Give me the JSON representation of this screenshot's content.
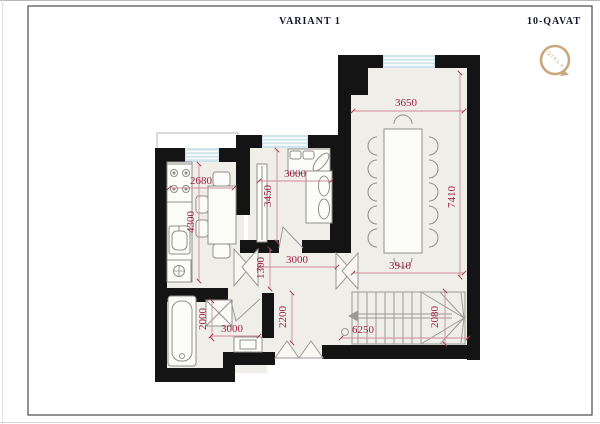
{
  "header": {
    "variant_label": "VARIANT 1",
    "floor_label": "10-QAVAT"
  },
  "logo": {
    "label": "QIBLA"
  },
  "plan": {
    "dimensions": {
      "kitchen_width": "2680",
      "kitchen_depth": "4300",
      "bedroom_width": "3000",
      "bedroom_depth": "3450",
      "living_top_width": "3650",
      "living_depth": "7410",
      "living_bottom_width": "3910",
      "hall_width": "3000",
      "hall_offset": "1300",
      "entry_depth": "2200",
      "bath_width": "2000",
      "bath_length": "3000",
      "stair_run": "6250",
      "stair_width": "2080"
    },
    "colors": {
      "wall": "#141414",
      "floor": "#f0eee8",
      "window": "#cfe3ea",
      "dimension_text": "#9e2142",
      "dimension_line": "#cf8b99",
      "furniture_line": "#8f8f8a",
      "logo_accent": "#c9a87e"
    }
  }
}
